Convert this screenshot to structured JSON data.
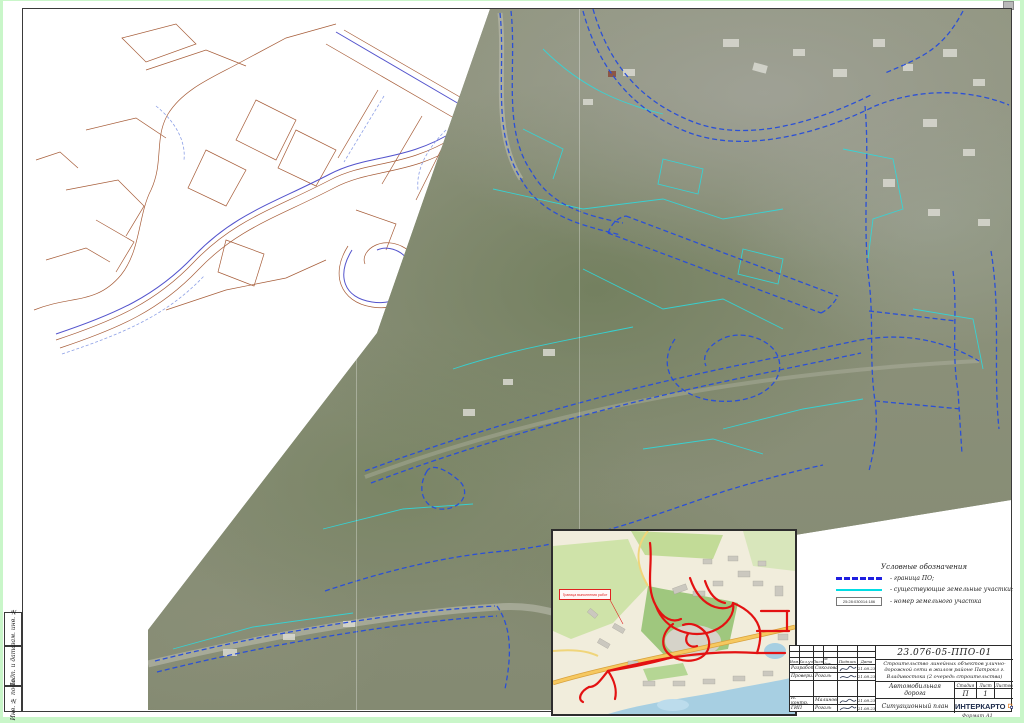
{
  "sheet": {
    "format_label": "Формат А1"
  },
  "margin_labels": {
    "top": "Взам. инв. №",
    "middle": "Подп. и дата",
    "bottom": "Инв. № подл."
  },
  "legend": {
    "title": "Условные обозначения",
    "item1_label": "- граница ПО;",
    "item2_label": "- существующие земельные участки;",
    "item3_label": "- номер земельного участка",
    "parcel_number": "25:28:030014:186",
    "colors": {
      "project_line": "#1f1fe0",
      "parcel_line": "#00dde4",
      "inset_roads": "#e31212"
    }
  },
  "inset": {
    "label": "Граница выполнения работ"
  },
  "title_block": {
    "doc_code": "23.076-05-ППО-01",
    "project_name": "Строительство линейных объектов улично-дорожной сети в жилом районе Патрокл г. Владивостока (2 очередь строительства)",
    "object_name": "Автомобильная дорога",
    "sheet_name": "Ситуационный план",
    "company": "ИНТЕРКАРТО",
    "columns": {
      "c1": "Изм.",
      "c2": "Кол.уч.",
      "c3": "Лист",
      "c4": "№ док.",
      "c5": "Подпись",
      "c6": "Дата"
    },
    "stage_block": {
      "h1": "Стадия",
      "h2": "Лист",
      "h3": "Листов",
      "stage": "П",
      "sheet": "1",
      "total": ""
    },
    "rows": [
      {
        "role": "Разработал",
        "name": "Соколова",
        "date": "21.08.23"
      },
      {
        "role": "Проверил",
        "name": "Рогаль",
        "date": "21.08.23"
      },
      {
        "role": "Н. контр.",
        "name": "Малиновский",
        "date": "21.08.23"
      },
      {
        "role": "ГИП",
        "name": "Рогаль",
        "date": "21.08.23"
      }
    ]
  }
}
